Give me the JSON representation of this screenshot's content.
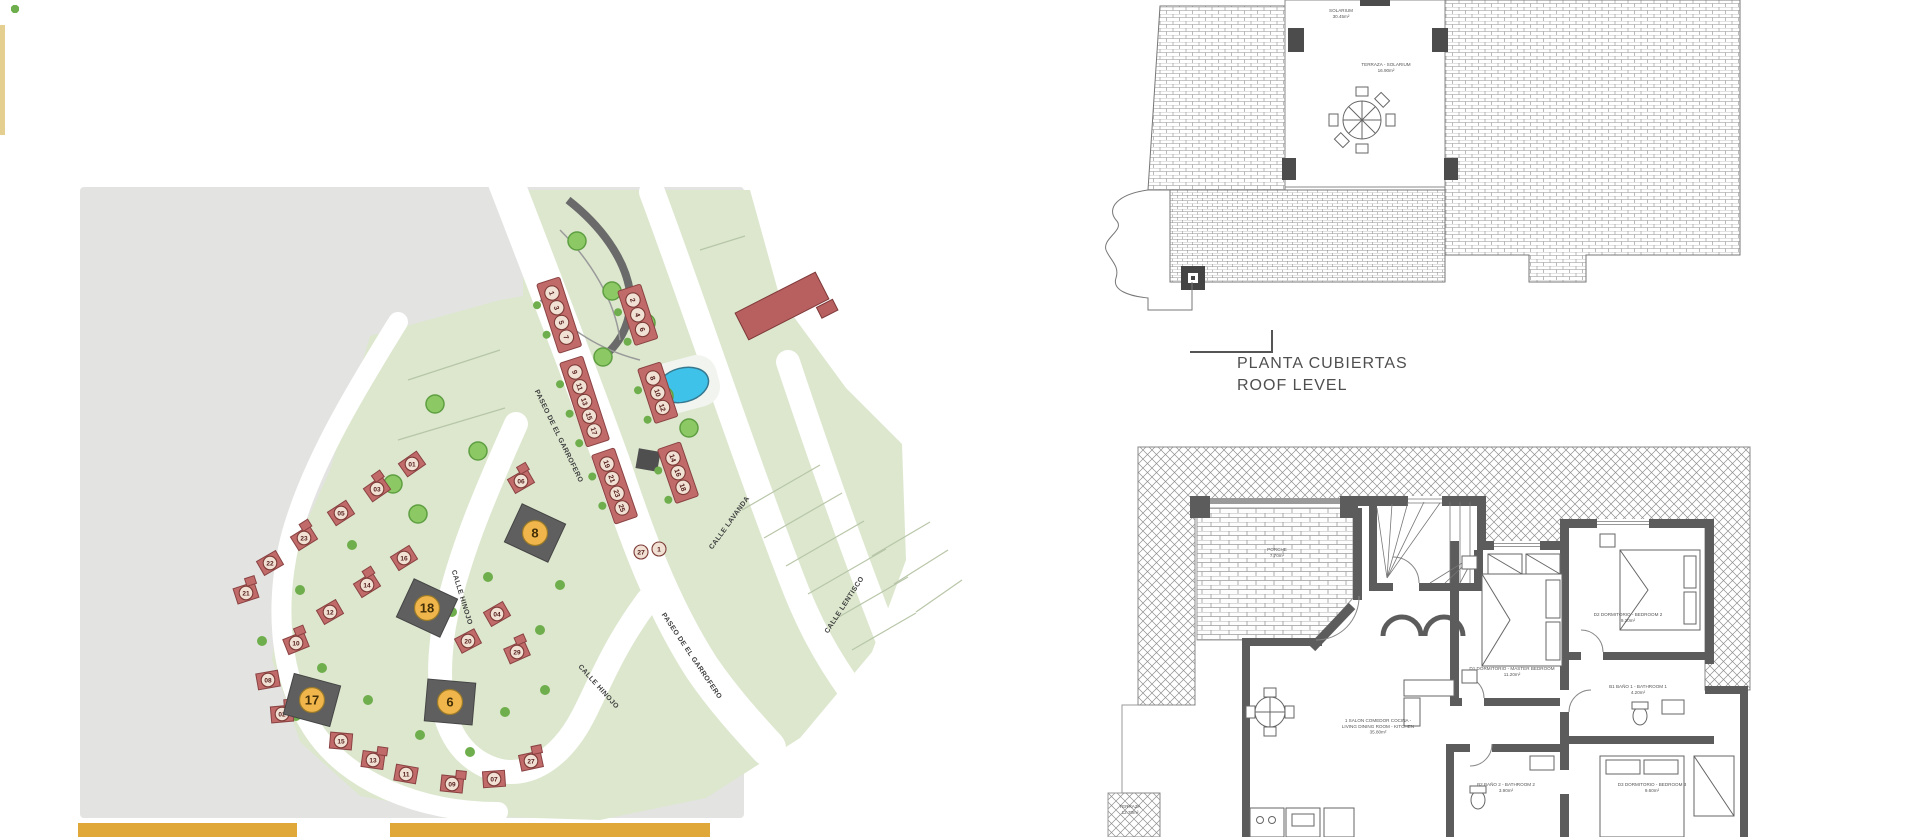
{
  "accents": {
    "left_strip": "#E4CF91",
    "bottom_bar": "#DFA838",
    "site_gray": "#E3E3E2",
    "site_green": "#DCE7CE",
    "house_red": "#C16A6A",
    "house_stroke": "#8A4242",
    "circle_fill": "#F1E0D4",
    "circle_stroke": "#7D3B36",
    "number_color": "#56201D",
    "plot_dark": "#5F5F5F",
    "badge_gold": "#F0B54B",
    "badge_stroke": "#9A7A28",
    "badge_text": "#432F07",
    "pool_blue": "#3FC2E9",
    "tree_green": "#8CC863",
    "tree_stroke": "#5F9F42",
    "shrub_green": "#6FAE4C",
    "wall_gray": "#5C5C5C"
  },
  "site_plan": {
    "streets": [
      {
        "label": "PASEO DE EL GARROFERO",
        "x": 557,
        "y": 437,
        "rot": 64
      },
      {
        "label": "PASEO DE EL GARROFERO",
        "x": 690,
        "y": 657,
        "rot": 56
      },
      {
        "label": "CALLE LAVANDA",
        "x": 731,
        "y": 524,
        "rot": -54
      },
      {
        "label": "CALLE LENTISCO",
        "x": 846,
        "y": 606,
        "rot": -57
      },
      {
        "label": "CALLE HINOJO",
        "x": 460,
        "y": 598,
        "rot": 73
      },
      {
        "label": "CALLE HINOJO",
        "x": 597,
        "y": 688,
        "rot": 48
      }
    ],
    "terrace_blocks": [
      {
        "x": 552,
        "y": 293,
        "angle": 72,
        "nums": [
          "1",
          "3",
          "5",
          "7"
        ]
      },
      {
        "x": 575,
        "y": 372,
        "angle": 72,
        "nums": [
          "9",
          "11",
          "13",
          "15",
          "17"
        ]
      },
      {
        "x": 607,
        "y": 464,
        "angle": 71,
        "nums": [
          "19",
          "21",
          "23",
          "25"
        ]
      },
      {
        "x": 633,
        "y": 300,
        "angle": 72,
        "nums": [
          "2",
          "4",
          "6"
        ]
      },
      {
        "x": 653,
        "y": 378,
        "angle": 72,
        "nums": [
          "8",
          "10",
          "12"
        ]
      },
      {
        "x": 673,
        "y": 458,
        "angle": 71,
        "nums": [
          "14",
          "16",
          "18"
        ]
      }
    ],
    "end_units": [
      {
        "n": "27",
        "x": 641,
        "y": 552
      },
      {
        "n": "1",
        "x": 659,
        "y": 549
      }
    ],
    "houses": [
      {
        "n": "01",
        "x": 412,
        "y": 464,
        "r": -35
      },
      {
        "n": "03",
        "x": 377,
        "y": 489,
        "r": -35
      },
      {
        "n": "05",
        "x": 341,
        "y": 513,
        "r": -33
      },
      {
        "n": "23",
        "x": 304,
        "y": 538,
        "r": -32
      },
      {
        "n": "22",
        "x": 270,
        "y": 563,
        "r": -30
      },
      {
        "n": "21",
        "x": 246,
        "y": 593,
        "r": -18
      },
      {
        "n": "16",
        "x": 404,
        "y": 558,
        "r": -32
      },
      {
        "n": "14",
        "x": 367,
        "y": 585,
        "r": -32
      },
      {
        "n": "12",
        "x": 330,
        "y": 612,
        "r": -30
      },
      {
        "n": "10",
        "x": 296,
        "y": 643,
        "r": -22
      },
      {
        "n": "08",
        "x": 268,
        "y": 680,
        "r": -10
      },
      {
        "n": "02",
        "x": 282,
        "y": 714,
        "r": -5
      },
      {
        "n": "20",
        "x": 468,
        "y": 641,
        "r": -28
      },
      {
        "n": "29",
        "x": 517,
        "y": 652,
        "r": -24
      },
      {
        "n": "04",
        "x": 497,
        "y": 614,
        "r": -30
      },
      {
        "n": "06",
        "x": 521,
        "y": 481,
        "r": -30
      },
      {
        "n": "15",
        "x": 341,
        "y": 741,
        "r": 5
      },
      {
        "n": "13",
        "x": 373,
        "y": 760,
        "r": 8
      },
      {
        "n": "11",
        "x": 406,
        "y": 774,
        "r": 10
      },
      {
        "n": "09",
        "x": 452,
        "y": 784,
        "r": 6
      },
      {
        "n": "07",
        "x": 494,
        "y": 779,
        "r": -4
      },
      {
        "n": "27",
        "x": 531,
        "y": 761,
        "r": -12
      }
    ],
    "featured_plots": [
      {
        "n": "8",
        "x": 535,
        "y": 533,
        "rot": 25
      },
      {
        "n": "18",
        "x": 427,
        "y": 608,
        "rot": 25
      },
      {
        "n": "17",
        "x": 312,
        "y": 700,
        "rot": 15
      },
      {
        "n": "6",
        "x": 450,
        "y": 702,
        "rot": 5
      }
    ],
    "trees_big": [
      [
        612,
        291
      ],
      [
        646,
        323
      ],
      [
        664,
        396
      ],
      [
        689,
        428
      ],
      [
        603,
        357
      ],
      [
        577,
        241
      ],
      [
        435,
        404
      ],
      [
        478,
        451
      ],
      [
        393,
        484
      ],
      [
        418,
        514
      ]
    ],
    "trees_small": [
      [
        300,
        590
      ],
      [
        352,
        545
      ],
      [
        322,
        668
      ],
      [
        368,
        700
      ],
      [
        420,
        735
      ],
      [
        470,
        752
      ],
      [
        505,
        712
      ],
      [
        545,
        690
      ],
      [
        452,
        612
      ],
      [
        488,
        577
      ],
      [
        296,
        716
      ],
      [
        262,
        641
      ],
      [
        540,
        630
      ],
      [
        560,
        585
      ]
    ]
  },
  "roof_plan": {
    "title_es": "PLANTA CUBIERTAS",
    "title_en": "ROOF LEVEL",
    "labels": [
      {
        "lines": [
          "SOLARIUM",
          "30.45m²"
        ],
        "x": 1341,
        "y": 12
      },
      {
        "lines": [
          "TERRAZA - SOLARIUM",
          "16.90m²"
        ],
        "x": 1386,
        "y": 66
      }
    ]
  },
  "floor_plan": {
    "labels": [
      {
        "lines": [
          "PORCHE",
          "7.70m²"
        ],
        "x": 1277,
        "y": 551
      },
      {
        "lines": [
          "1 SALON COMEDOR COCINA -",
          "LIVING DINING ROOM - KITCHEN",
          "35.80m²"
        ],
        "x": 1378,
        "y": 722
      },
      {
        "lines": [
          "D1 DORMITORIO - MASTER BEDROOM",
          "11.20m²"
        ],
        "x": 1512,
        "y": 670
      },
      {
        "lines": [
          "D2 DORMITORIO - BEDROOM 2",
          "9.20m²"
        ],
        "x": 1628,
        "y": 616
      },
      {
        "lines": [
          "B1 BAÑO 1 - BATHROOM 1",
          "4.20m²"
        ],
        "x": 1638,
        "y": 688
      },
      {
        "lines": [
          "B2 BAÑO 2 - BATHROOM 2",
          "3.90m²"
        ],
        "x": 1506,
        "y": 786
      },
      {
        "lines": [
          "D3 DORMITORIO - BEDROOM 3",
          "9.60m²"
        ],
        "x": 1652,
        "y": 786
      },
      {
        "lines": [
          "TERRAZA",
          "12.70m²"
        ],
        "x": 1130,
        "y": 808
      }
    ]
  }
}
